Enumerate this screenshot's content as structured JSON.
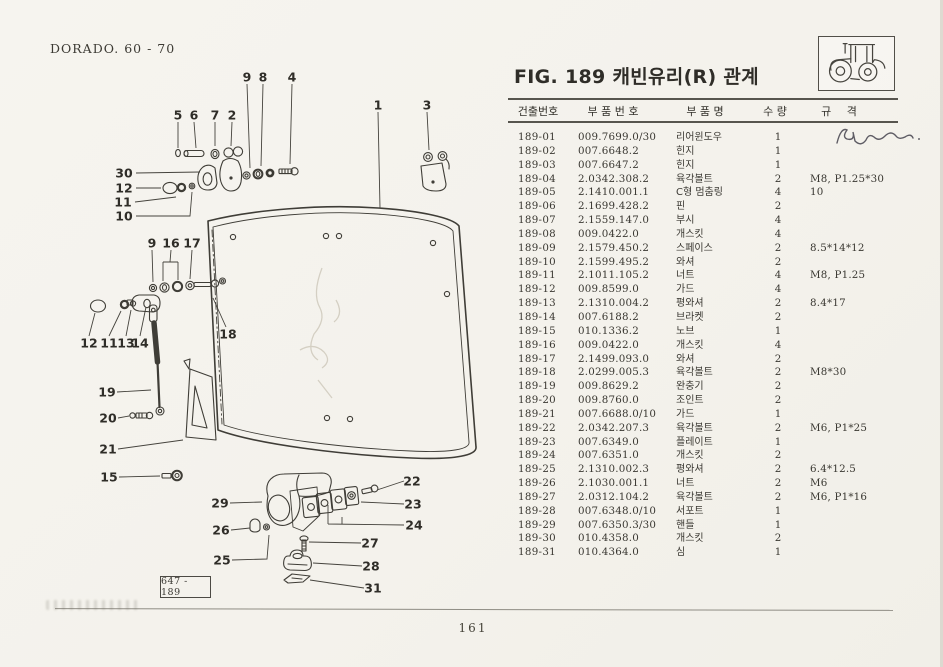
{
  "colors": {
    "paper": "#f4f2ec",
    "ink": "#34322c",
    "rule": "#413f38"
  },
  "page": {
    "header_left": "DORADO. 60 - 70",
    "page_number": "161"
  },
  "figure": {
    "title": "FIG. 189 캐빈유리(R) 관계",
    "diagram_ref": "647 - 189",
    "tractor_icon": "tractor-icon",
    "handwriting_icon": "pen-scribble-icon"
  },
  "table": {
    "headers": {
      "id": "건출번호",
      "part_no": "부 품 번 호",
      "name": "부 품 명",
      "qty": "수 량",
      "spec": "규 격"
    },
    "rows": [
      {
        "id": "189-01",
        "part_no": "009.7699.0/30",
        "name": "리어윈도우",
        "qty": "1",
        "spec": ""
      },
      {
        "id": "189-02",
        "part_no": "007.6648.2",
        "name": "힌지",
        "qty": "1",
        "spec": ""
      },
      {
        "id": "189-03",
        "part_no": "007.6647.2",
        "name": "힌지",
        "qty": "1",
        "spec": ""
      },
      {
        "id": "189-04",
        "part_no": "2.0342.308.2",
        "name": "육각볼트",
        "qty": "2",
        "spec": "M8, P1.25*30"
      },
      {
        "id": "189-05",
        "part_no": "2.1410.001.1",
        "name": "C형 멈춤링",
        "qty": "4",
        "spec": "10"
      },
      {
        "id": "189-06",
        "part_no": "2.1699.428.2",
        "name": "핀",
        "qty": "2",
        "spec": ""
      },
      {
        "id": "189-07",
        "part_no": "2.1559.147.0",
        "name": "부시",
        "qty": "4",
        "spec": ""
      },
      {
        "id": "189-08",
        "part_no": "009.0422.0",
        "name": "개스킷",
        "qty": "4",
        "spec": ""
      },
      {
        "id": "189-09",
        "part_no": "2.1579.450.2",
        "name": "스페이스",
        "qty": "2",
        "spec": "8.5*14*12"
      },
      {
        "id": "189-10",
        "part_no": "2.1599.495.2",
        "name": "와셔",
        "qty": "2",
        "spec": ""
      },
      {
        "id": "189-11",
        "part_no": "2.1011.105.2",
        "name": "너트",
        "qty": "4",
        "spec": "M8, P1.25"
      },
      {
        "id": "189-12",
        "part_no": "009.8599.0",
        "name": "가드",
        "qty": "4",
        "spec": ""
      },
      {
        "id": "189-13",
        "part_no": "2.1310.004.2",
        "name": "평와셔",
        "qty": "2",
        "spec": "8.4*17"
      },
      {
        "id": "189-14",
        "part_no": "007.6188.2",
        "name": "브라켓",
        "qty": "2",
        "spec": ""
      },
      {
        "id": "189-15",
        "part_no": "010.1336.2",
        "name": "노브",
        "qty": "1",
        "spec": ""
      },
      {
        "id": "189-16",
        "part_no": "009.0422.0",
        "name": "개스킷",
        "qty": "4",
        "spec": ""
      },
      {
        "id": "189-17",
        "part_no": "2.1499.093.0",
        "name": "와셔",
        "qty": "2",
        "spec": ""
      },
      {
        "id": "189-18",
        "part_no": "2.0299.005.3",
        "name": "육각볼트",
        "qty": "2",
        "spec": "M8*30"
      },
      {
        "id": "189-19",
        "part_no": "009.8629.2",
        "name": "완충기",
        "qty": "2",
        "spec": ""
      },
      {
        "id": "189-20",
        "part_no": "009.8760.0",
        "name": "조인트",
        "qty": "2",
        "spec": ""
      },
      {
        "id": "189-21",
        "part_no": "007.6688.0/10",
        "name": "가드",
        "qty": "1",
        "spec": ""
      },
      {
        "id": "189-22",
        "part_no": "2.0342.207.3",
        "name": "육각볼트",
        "qty": "2",
        "spec": "M6, P1*25"
      },
      {
        "id": "189-23",
        "part_no": "007.6349.0",
        "name": "플레이트",
        "qty": "1",
        "spec": ""
      },
      {
        "id": "189-24",
        "part_no": "007.6351.0",
        "name": "개스킷",
        "qty": "2",
        "spec": ""
      },
      {
        "id": "189-25",
        "part_no": "2.1310.002.3",
        "name": "평와셔",
        "qty": "2",
        "spec": "6.4*12.5"
      },
      {
        "id": "189-26",
        "part_no": "2.1030.001.1",
        "name": "너트",
        "qty": "2",
        "spec": "M6"
      },
      {
        "id": "189-27",
        "part_no": "2.0312.104.2",
        "name": "육각볼트",
        "qty": "2",
        "spec": "M6, P1*16"
      },
      {
        "id": "189-28",
        "part_no": "007.6348.0/10",
        "name": "서포트",
        "qty": "1",
        "spec": ""
      },
      {
        "id": "189-29",
        "part_no": "007.6350.3/30",
        "name": "핸들",
        "qty": "1",
        "spec": ""
      },
      {
        "id": "189-30",
        "part_no": "010.4358.0",
        "name": "개스킷",
        "qty": "2",
        "spec": ""
      },
      {
        "id": "189-31",
        "part_no": "010.4364.0",
        "name": "심",
        "qty": "1",
        "spec": ""
      }
    ]
  },
  "diagram": {
    "callouts": [
      {
        "n": "9",
        "x": 247,
        "y": 77
      },
      {
        "n": "8",
        "x": 263,
        "y": 77
      },
      {
        "n": "4",
        "x": 292,
        "y": 77
      },
      {
        "n": "5",
        "x": 178,
        "y": 115
      },
      {
        "n": "6",
        "x": 194,
        "y": 115
      },
      {
        "n": "7",
        "x": 215,
        "y": 115
      },
      {
        "n": "2",
        "x": 232,
        "y": 115
      },
      {
        "n": "1",
        "x": 378,
        "y": 105
      },
      {
        "n": "3",
        "x": 427,
        "y": 105
      },
      {
        "n": "30",
        "x": 124,
        "y": 173
      },
      {
        "n": "12",
        "x": 124,
        "y": 188
      },
      {
        "n": "11",
        "x": 123,
        "y": 202
      },
      {
        "n": "10",
        "x": 124,
        "y": 216
      },
      {
        "n": "9",
        "x": 152,
        "y": 243
      },
      {
        "n": "16",
        "x": 171,
        "y": 243
      },
      {
        "n": "17",
        "x": 192,
        "y": 243
      },
      {
        "n": "12",
        "x": 89,
        "y": 343
      },
      {
        "n": "11",
        "x": 109,
        "y": 343
      },
      {
        "n": "13",
        "x": 126,
        "y": 343
      },
      {
        "n": "14",
        "x": 140,
        "y": 343
      },
      {
        "n": "18",
        "x": 228,
        "y": 334
      },
      {
        "n": "19",
        "x": 107,
        "y": 392
      },
      {
        "n": "20",
        "x": 108,
        "y": 418
      },
      {
        "n": "21",
        "x": 108,
        "y": 449
      },
      {
        "n": "15",
        "x": 109,
        "y": 477
      },
      {
        "n": "29",
        "x": 220,
        "y": 503
      },
      {
        "n": "26",
        "x": 221,
        "y": 530
      },
      {
        "n": "25",
        "x": 222,
        "y": 560
      },
      {
        "n": "22",
        "x": 412,
        "y": 481
      },
      {
        "n": "23",
        "x": 413,
        "y": 504
      },
      {
        "n": "24",
        "x": 414,
        "y": 525
      },
      {
        "n": "27",
        "x": 370,
        "y": 543
      },
      {
        "n": "28",
        "x": 371,
        "y": 566
      },
      {
        "n": "31",
        "x": 373,
        "y": 588
      }
    ]
  }
}
